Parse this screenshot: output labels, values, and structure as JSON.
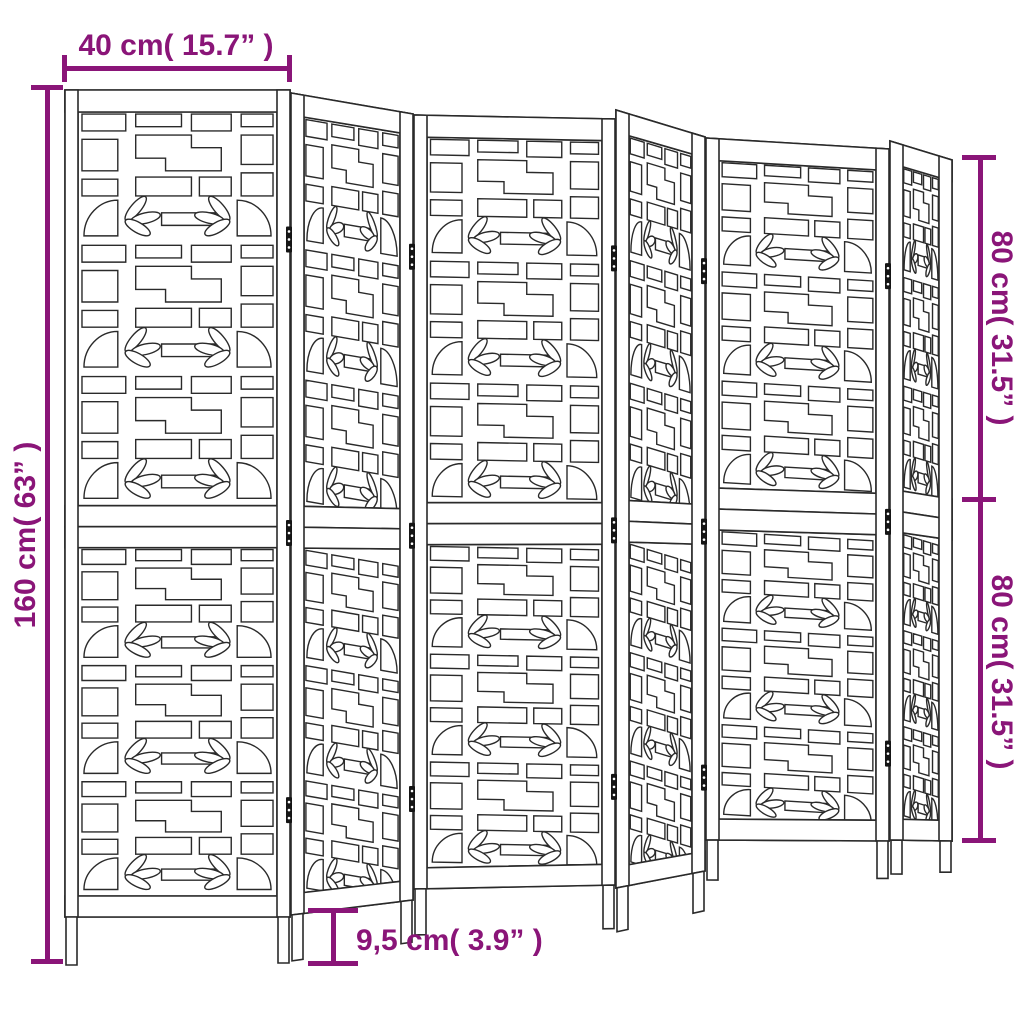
{
  "figure": {
    "subject": "Six-panel folding room divider with decorative lattice fretwork, perspective line drawing",
    "panel_count": 6
  },
  "dimensions": {
    "top_width": "40 cm( 15.7” )",
    "left_height": "160 cm( 63” )",
    "right_upper": "80 cm( 31.5” )",
    "right_lower": "80 cm( 31.5” )",
    "bottom_leg": "9,5 cm( 3.9” )"
  },
  "colors": {
    "dimension": "#8a1578",
    "line": "#2a2a2a",
    "background": "#ffffff"
  }
}
